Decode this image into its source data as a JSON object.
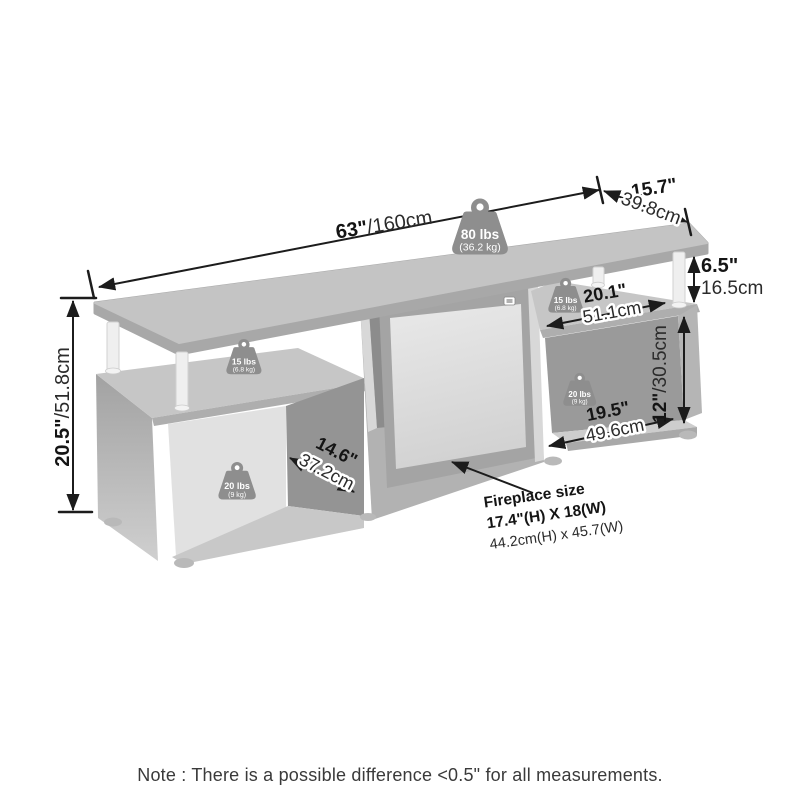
{
  "dimensions": {
    "overall_width": {
      "inches": "63\"",
      "cm": "/160cm"
    },
    "depth": {
      "inches": "15.7\"",
      "cm": "39.8cm"
    },
    "top_shelf_gap": {
      "inches": "6.5\"",
      "cm": "16.5cm"
    },
    "overall_height": {
      "inches": "20.5\"",
      "cm": "/51.8cm"
    },
    "left_compartment_depth": {
      "inches": "14.6\"",
      "cm": "37.2cm"
    },
    "right_shelf_width": {
      "inches": "20.1\"",
      "cm": "51.1cm"
    },
    "right_compartment_height": {
      "inches": "12\"",
      "cm": "/30.5cm"
    },
    "right_compartment_width": {
      "inches": "19.5\"",
      "cm": "49.6cm"
    }
  },
  "weight_capacities": {
    "top_shelf": {
      "lbs": "80 lbs",
      "kg": "(36.2 kg)"
    },
    "left_middle_shelf": {
      "lbs": "15 lbs",
      "kg": "(6.8 kg)"
    },
    "right_middle_shelf": {
      "lbs": "15 lbs",
      "kg": "(6.8 kg)"
    },
    "left_bottom_compartment": {
      "lbs": "20 lbs",
      "kg": "(9 kg)"
    },
    "right_bottom_compartment": {
      "lbs": "20 lbs",
      "kg": "(9 kg)"
    }
  },
  "fireplace": {
    "label": "Fireplace size",
    "size_imperial": "17.4\"(H) X 18(W)",
    "size_metric": "44.2cm(H) x 45.7(W)"
  },
  "note": "Note : There is a possible difference <0.5\" for all measurements.",
  "colors": {
    "dimension_line": "#1c1c1c",
    "weight_badge": "#8e8e8e",
    "note_text": "#3a3a3a"
  }
}
